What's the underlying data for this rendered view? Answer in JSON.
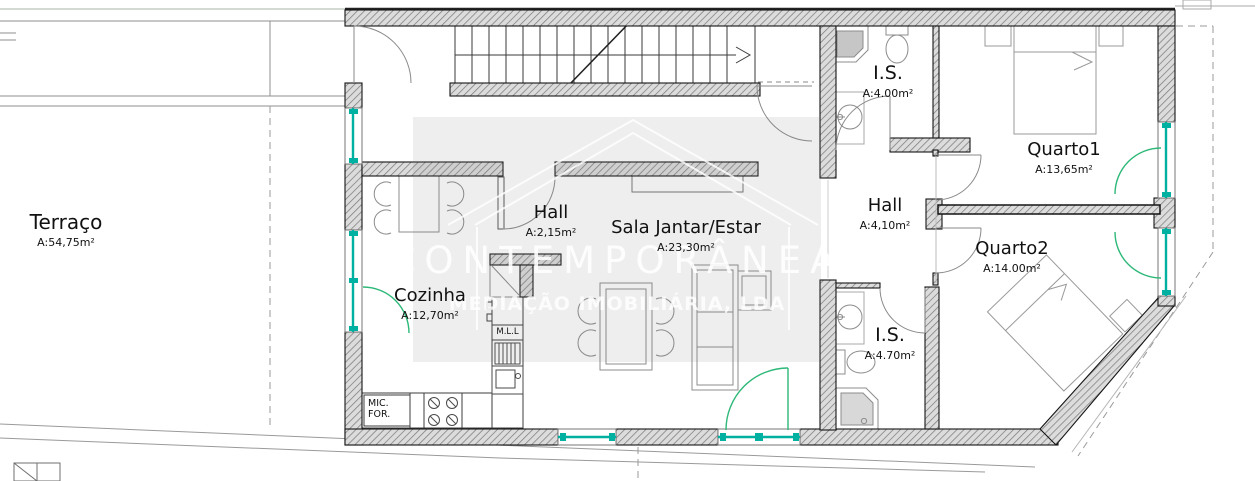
{
  "watermark": {
    "brand": "CONTEMPORÂNEA",
    "subtitle": "MEDIAÇÃO IMOBILIÁRIA, LDA"
  },
  "rooms": {
    "terraco": {
      "name": "Terraço",
      "area": "A:54,75m²"
    },
    "hall_entry": {
      "name": "Hall",
      "area": "A:2,15m²"
    },
    "sala": {
      "name": "Sala Jantar/Estar",
      "area": "A:23,30m²"
    },
    "cozinha": {
      "name": "Cozinha",
      "area": "A:12,70m²"
    },
    "is_top": {
      "name": "I.S.",
      "area": "A:4.00m²"
    },
    "quarto1": {
      "name": "Quarto1",
      "area": "A:13,65m²"
    },
    "hall_right": {
      "name": "Hall",
      "area": "A:4,10m²"
    },
    "quarto2": {
      "name": "Quarto2",
      "area": "A:14.00m²"
    },
    "is_bottom": {
      "name": "I.S.",
      "area": "A:4.70m²"
    }
  },
  "appliances": {
    "mll": "M.L.L",
    "mic": "MIC.",
    "forn": "FOR."
  },
  "colors": {
    "window": "#00b0a0",
    "door_arc": "#2db878"
  }
}
